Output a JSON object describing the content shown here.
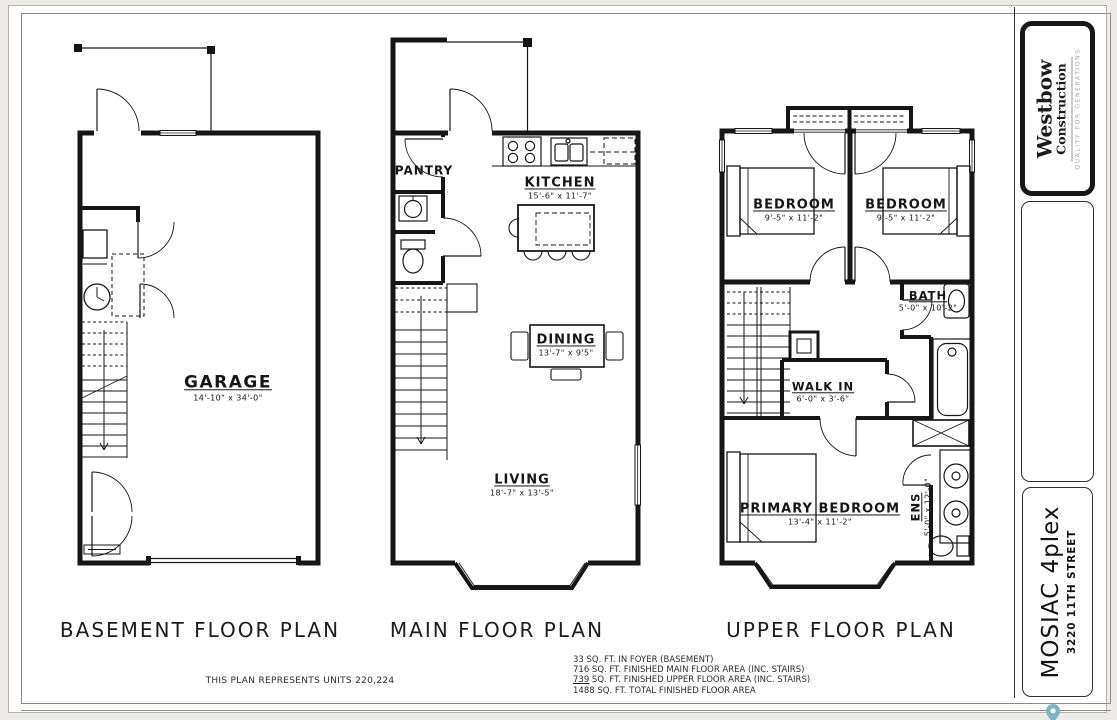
{
  "titles": {
    "basement": "BASEMENT FLOOR PLAN",
    "main": "MAIN FLOOR PLAN",
    "upper": "UPPER FLOOR PLAN"
  },
  "rooms": {
    "garage": {
      "name": "GARAGE",
      "dims": "14'-10\" x 34'-0\""
    },
    "pantry": {
      "name": "PANTRY"
    },
    "kitchen": {
      "name": "KITCHEN",
      "dims": "15'-6\" x 11'-7\""
    },
    "dining": {
      "name": "DINING",
      "dims": "13'-7\" x 9'5\""
    },
    "living": {
      "name": "LIVING",
      "dims": "18'-7\" x 13'-5\""
    },
    "bedroom_left": {
      "name": "BEDROOM",
      "dims": "9'-5\" x 11'-2\""
    },
    "bedroom_right": {
      "name": "BEDROOM",
      "dims": "9'-5\" x 11'-2\""
    },
    "bath": {
      "name": "BATH",
      "dims": "5'-0\" x 10'-2\""
    },
    "walk_in": {
      "name": "WALK IN",
      "dims": "6'-0\" x 3'-6\""
    },
    "primary": {
      "name": "PRIMARY BEDROOM",
      "dims": "13'-4\" x 11'-2\""
    },
    "ensuite": {
      "name": "ENS",
      "dims": "5'-0\" x 12'-0\""
    }
  },
  "sheet": {
    "note_units": "THIS PLAN REPRESENTS UNITS 220,224",
    "areas": {
      "line1": "33 SQ. FT. IN FOYER (BASEMENT)",
      "line2": "716 SQ. FT. FINISHED MAIN FLOOR AREA (INC. STAIRS)",
      "line3_num": "739",
      "line3_rest": " SQ. FT. FINISHED UPPER FLOOR AREA (INC. STAIRS)",
      "line4": "1488 SQ. FT. TOTAL FINISHED FLOOR AREA"
    }
  },
  "title_block": {
    "brand_line1": "Westbow",
    "brand_line2": "Construction",
    "brand_tagline": "QUALITY FOR GENERATIONS",
    "project_name": "MOSIAC 4plex",
    "project_address": "3220 11TH STREET"
  },
  "colors": {
    "line": "#161616",
    "frame": "#8e8c88",
    "pin": "#7fb2c4"
  }
}
